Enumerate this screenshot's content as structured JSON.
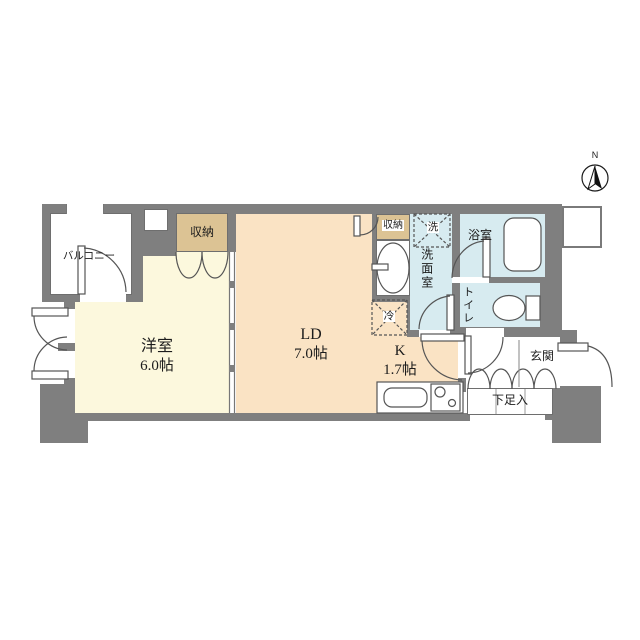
{
  "compass": {
    "north_label": "N"
  },
  "colors": {
    "wall": "#7f7f7f",
    "western_room_fill": "#fcf8dd",
    "living_dining_fill": "#fae3c4",
    "closet_fill": "#dcc394",
    "wet_area_fill": "#d7ebf0",
    "line": "#555555"
  },
  "rooms": {
    "balcony": {
      "label": "バルコニー"
    },
    "western_room": {
      "label": "洋室",
      "size": "6.0帖"
    },
    "living_dining": {
      "label": "LD",
      "size": "7.0帖"
    },
    "kitchen": {
      "label": "K",
      "size": "1.7帖"
    },
    "closet_bedroom": {
      "label": "収納"
    },
    "closet_ld": {
      "label": "収納"
    },
    "washroom": {
      "label": "洗面室"
    },
    "washer_space": {
      "label": "洗"
    },
    "fridge_space": {
      "label": "冷"
    },
    "bathroom": {
      "label": "浴室"
    },
    "toilet": {
      "label": "トイレ"
    },
    "entrance": {
      "label": "玄関"
    },
    "shoe_cabinet": {
      "label": "下足入"
    }
  }
}
